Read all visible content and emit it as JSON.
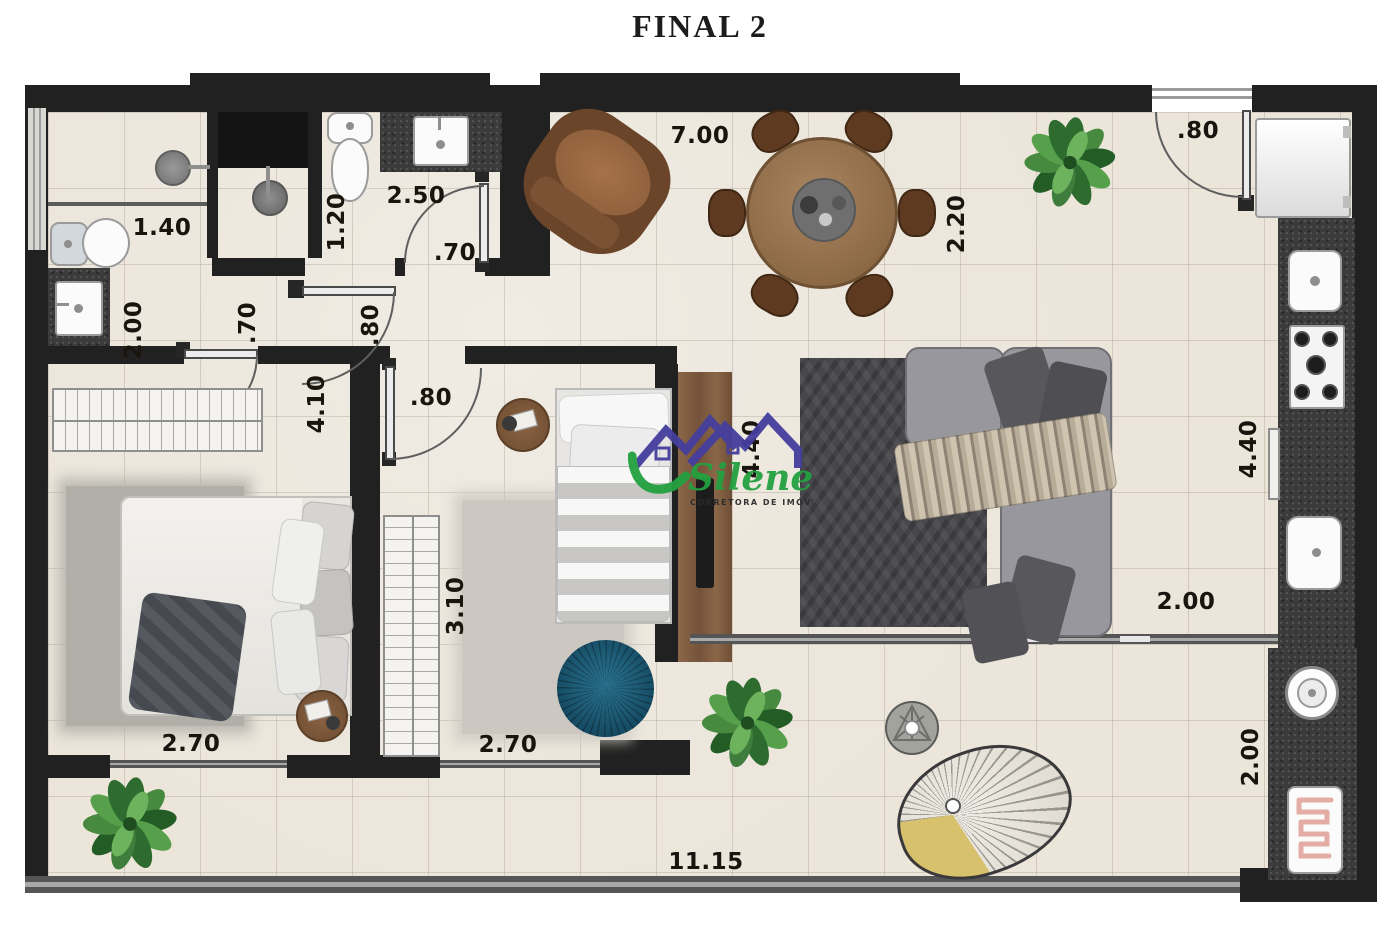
{
  "title": "FINAL 2",
  "watermark": {
    "brand": "Silene",
    "tagline": "CORRETORA DE IMÓVEIS"
  },
  "dimensions": [
    {
      "area": "living-top-width",
      "label": "7.00"
    },
    {
      "area": "dining-depth",
      "label": "2.20"
    },
    {
      "area": "kitchen-door-width",
      "label": ".80"
    },
    {
      "area": "bathroom1-shower-width",
      "label": "1.40"
    },
    {
      "area": "bathroom2-width",
      "label": "2.50"
    },
    {
      "area": "bathroom2-depth",
      "label": "1.20"
    },
    {
      "area": "bathroom2-door-width",
      "label": ".70"
    },
    {
      "area": "bathroom1-depth",
      "label": "2.00"
    },
    {
      "area": "hall-door1-width",
      "label": ".70"
    },
    {
      "area": "hall-door2-width",
      "label": ".80"
    },
    {
      "area": "bedroom1-length",
      "label": "4.10"
    },
    {
      "area": "bedroom2-door-width",
      "label": ".80"
    },
    {
      "area": "living-length",
      "label": "4.40"
    },
    {
      "area": "kitchen-length",
      "label": "4.40"
    },
    {
      "area": "bedroom2-length",
      "label": "3.10"
    },
    {
      "area": "bedroom1-width",
      "label": "2.70"
    },
    {
      "area": "bedroom2-width",
      "label": "2.70"
    },
    {
      "area": "living-balcony-width",
      "label": "2.00"
    },
    {
      "area": "laundry-depth",
      "label": "2.00"
    },
    {
      "area": "balcony-width",
      "label": "11.15"
    }
  ],
  "colors": {
    "wall": "#212121",
    "floor": "#ebe5da",
    "counter": "#3b3b3b",
    "wood": "#8a6748",
    "sofa": "#97979d",
    "cushion": "#55555a",
    "rug_living": "#47474c",
    "rug_bed1": "#b2afa9",
    "rug_bed2": "#ccc8c1",
    "pouf_blue": "#1b5f7e",
    "plant_green": "#3f7d3c",
    "armchair_brown": "#6b452a",
    "table_wood": "#9c7a58",
    "hammock_yellow": "#d8c16c",
    "fixture_white": "#fbfbfb",
    "logo_purple": "#453e9e",
    "logo_green": "#23a13f"
  }
}
